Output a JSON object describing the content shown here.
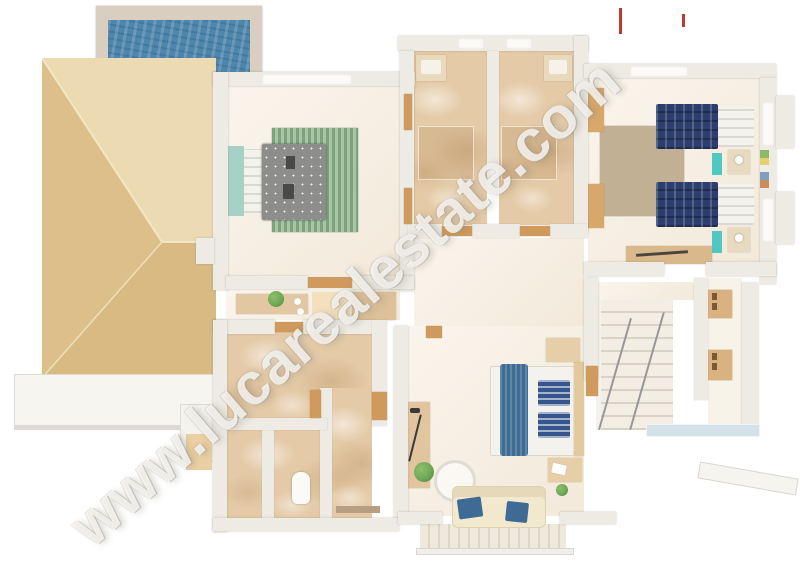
{
  "watermark": {
    "text": "www.lucarealestate.com"
  },
  "palette": {
    "background": "#ffffff",
    "pool_water": "#4e86ad",
    "pool_deck": "#d8cfc0",
    "roof_light": "#ecdab3",
    "roof_mid": "#ddbf8a",
    "roof_dark": "#d8ba82",
    "wall": "#edebe3",
    "floor_cream": "#f7efe2",
    "marble": "#e4caa7",
    "rug_green_a": "#7ca37d",
    "rug_green_b": "#a9c6a4",
    "rug_tan": "#c2b094",
    "bed_navy": "#2c3e6d",
    "accent_teal": "#4fc9c0",
    "headboard_teal": "#a6d2c6",
    "bed_blue": "#3e6c94",
    "sofa_cream": "#f1e8cd",
    "wood_door": "#cf9a5c",
    "wood_furniture": "#dcba8c",
    "plant_green": "#6da455",
    "stair_rail": "#97979a",
    "glass": "#d3e2e9",
    "watermark_text": "rgba(252,250,246,0.80)",
    "watermark_red": "#c0392b"
  }
}
